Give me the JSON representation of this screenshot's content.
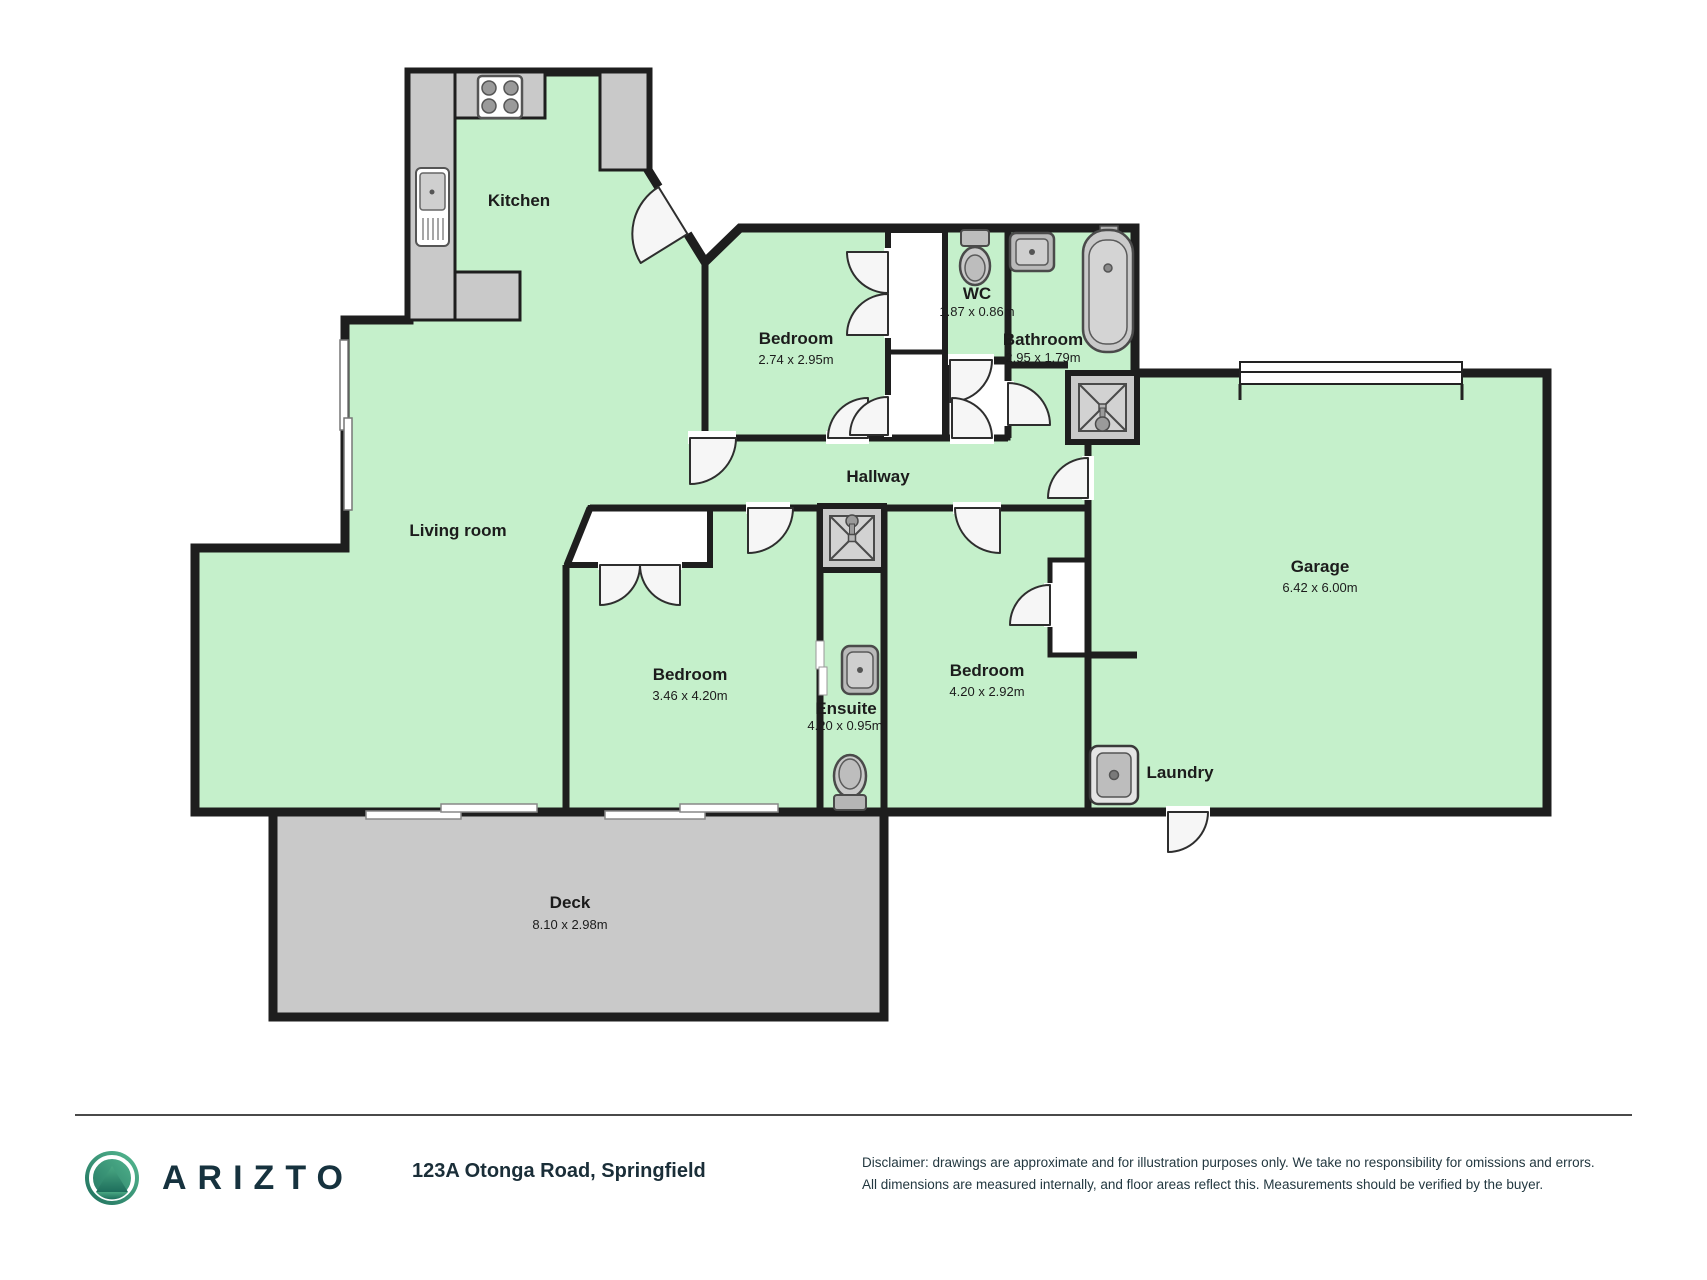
{
  "colors": {
    "room_fill": "#c5f0cb",
    "deck_fill": "#c9c9c9",
    "counter_fill": "#c9c9c9",
    "wall": "#1e1e1e",
    "fixture_gray": "#c4c4c4",
    "door_leaf": "#f6f6f6",
    "brand_dark": "#16323e",
    "logo_green_light": "#57bb92",
    "logo_green_dark": "#1e6e5c"
  },
  "rooms": {
    "kitchen": {
      "label": "Kitchen",
      "dims": ""
    },
    "living": {
      "label": "Living room",
      "dims": ""
    },
    "bedroom_top": {
      "label": "Bedroom",
      "dims": "2.74 x 2.95m"
    },
    "wc": {
      "label": "WC",
      "dims": "1.87 x 0.86m"
    },
    "bathroom": {
      "label": "Bathroom",
      "dims": "2.95 x 1.79m"
    },
    "hallway": {
      "label": "Hallway",
      "dims": ""
    },
    "garage": {
      "label": "Garage",
      "dims": "6.42 x 6.00m"
    },
    "bedroom_left": {
      "label": "Bedroom",
      "dims": "3.46 x 4.20m"
    },
    "ensuite": {
      "label": "Ensuite",
      "dims": "4.20 x 0.95m"
    },
    "bedroom_mid": {
      "label": "Bedroom",
      "dims": "4.20 x 2.92m"
    },
    "laundry": {
      "label": "Laundry",
      "dims": ""
    },
    "deck": {
      "label": "Deck",
      "dims": "8.10 x 2.98m"
    }
  },
  "fixtures": [
    "stove-icon",
    "kitchen-sink-icon",
    "wc-toilet-icon",
    "bathroom-sink-icon",
    "bathtub-icon",
    "shower-icon",
    "ensuite-shower-icon",
    "ensuite-sink-icon",
    "ensuite-toilet-icon",
    "laundry-tub-icon"
  ],
  "footer": {
    "brand": "ARIZTO",
    "address": "123A Otonga Road, Springfield",
    "disclaimer_line1": "Disclaimer: drawings are approximate and for illustration purposes only. We take no responsibility for omissions and errors.",
    "disclaimer_line2": "All dimensions are measured internally, and floor areas reflect this. Measurements should be verified by the buyer."
  }
}
